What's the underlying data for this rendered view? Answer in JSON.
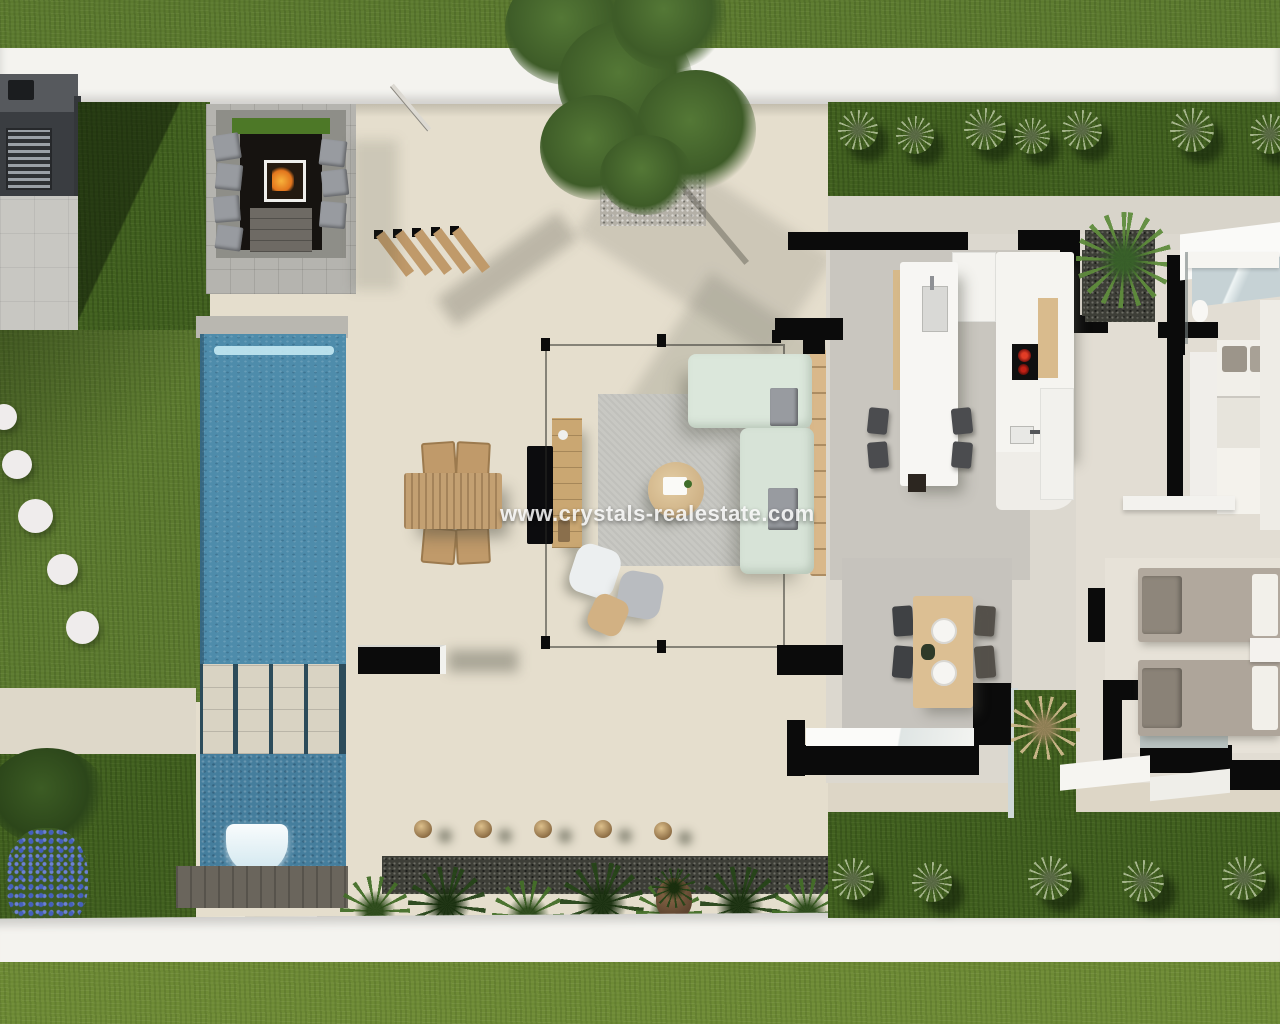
{
  "scene": {
    "type": "3d-floor-plan-render",
    "watermark": {
      "text": "www.crystals-realestate.com"
    },
    "palette": {
      "grass_top": "#5c7a2f",
      "grass_side": "#41601f",
      "grass_bottom": "#6d8a35",
      "terrace_beige": "#e5decd",
      "white_wall": "#f4f3ef",
      "pool_water": "#4e8cab",
      "pool_deep": "#457e9d",
      "interior_black_wall": "#0b0b0b",
      "wood_furniture": "#c09a6a",
      "sofa_upholstery": "#dbe7db",
      "fire_flame": "#e2751d",
      "hob_red": "#d32a18",
      "hydrangea_blue": "#4560bd"
    },
    "labels": {
      "outdoor_kitchen": "outdoor kitchen with grill",
      "fire_pit_lounge": "sunken fire-pit lounge",
      "pergola": "wooden pergola slats",
      "tree": "large tree over gravel bed",
      "pool": "swimming pool",
      "pool_steps": "stepping slabs across pool",
      "waterfall": "pool waterfall",
      "stepping_stones": "round stepping stones",
      "outdoor_dining": "outdoor wooden dining set",
      "tv_console": "outdoor TV console",
      "lounge": "outdoor lounge with L-sofa and coffee table",
      "kitchen_island": "kitchen island with sink",
      "kitchen_counter": "kitchen counter with induction hob",
      "indoor_dining": "indoor dining table with four chairs",
      "bedroom_top": "bedroom with double bed",
      "bedroom_bottom": "bedroom with two single beds",
      "bathroom": "bathroom",
      "courtyard": "interior grass courtyard with pampas plant",
      "garden_bottom": "front garden planting strip",
      "palm": "palm tree planter"
    }
  }
}
